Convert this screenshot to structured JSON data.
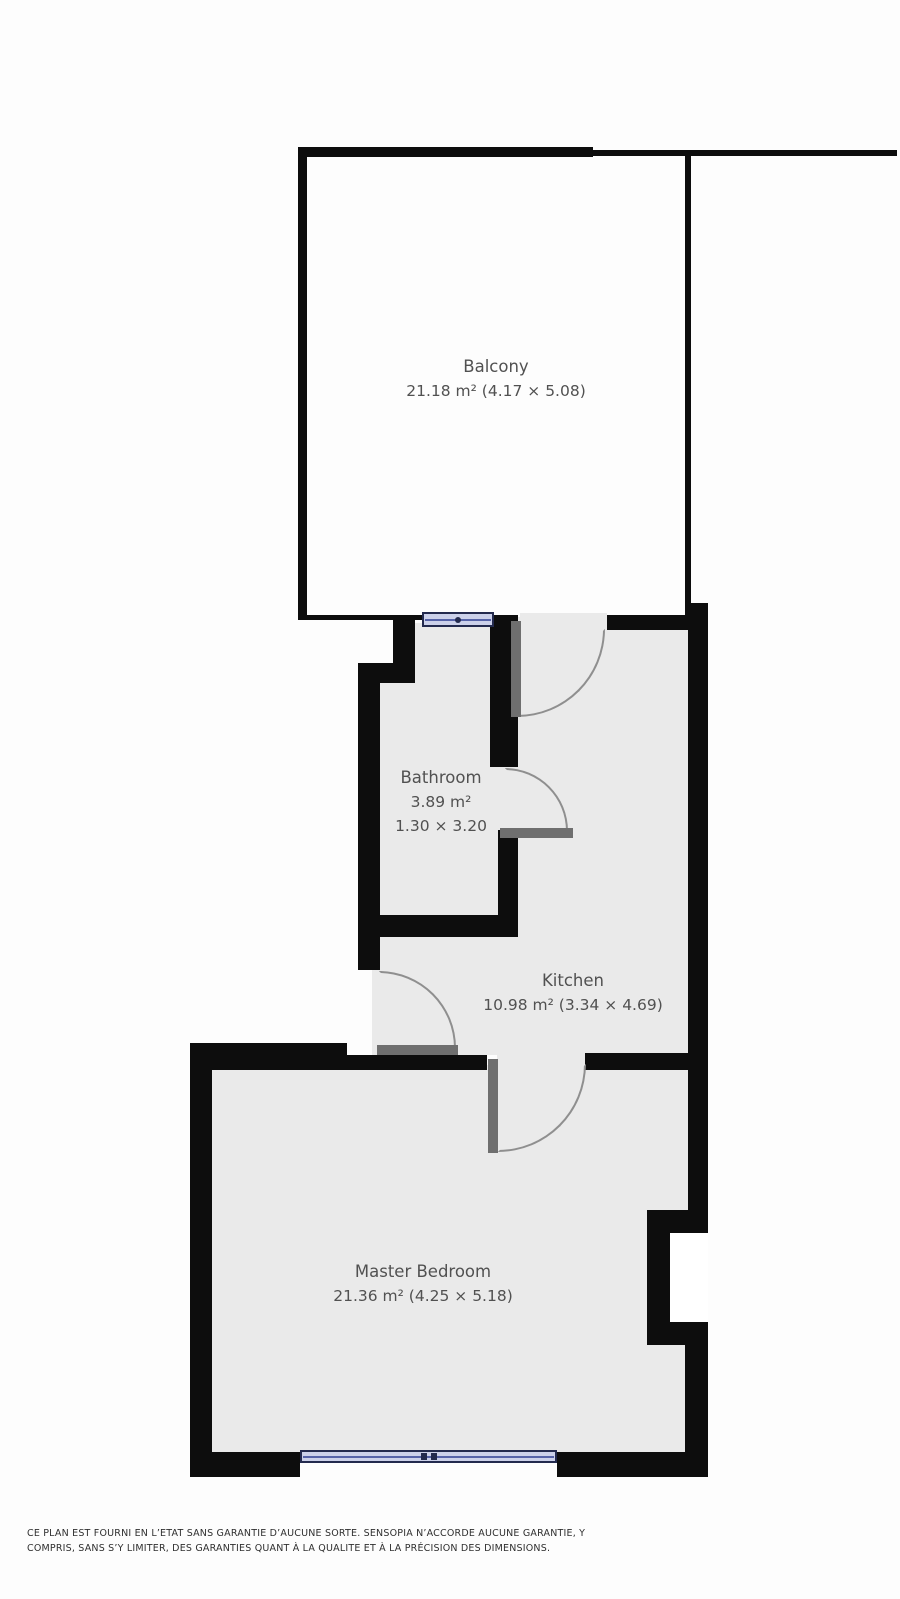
{
  "plan_title": "Apartment floor plan",
  "rooms": {
    "balcony": {
      "name": "Balcony",
      "dims": "21.18 m² (4.17 × 5.08)"
    },
    "bathroom": {
      "name": "Bathroom",
      "area": "3.89 m²",
      "dims": "1.30 × 3.20"
    },
    "kitchen": {
      "name": "Kitchen",
      "dims": "10.98 m² (3.34 × 4.69)"
    },
    "master": {
      "name": "Master Bedroom",
      "dims": "21.36 m² (4.25 × 5.18)"
    }
  },
  "footer": {
    "line1": "CE PLAN EST FOURNI EN L’ETAT SANS GARANTIE D’AUCUNE SORTE. SENSOPIA N’ACCORDE AUCUNE GARANTIE, Y",
    "line2": "COMPRIS, SANS S’Y LIMITER, DES GARANTIES QUANT À LA QUALITE ET À LA PRÉCISION DES DIMENSIONS."
  },
  "colors": {
    "wall": "#0d0d0d",
    "floor": "#eaeaea",
    "door_leaf": "#6f6f6f",
    "door_arc": "#8f8f8f",
    "window_fill": "#ccd1ea",
    "window_frame": "#232a4e",
    "window_line": "#5663a8",
    "room_text": "#515151",
    "footer_text": "#2f2f2f"
  }
}
